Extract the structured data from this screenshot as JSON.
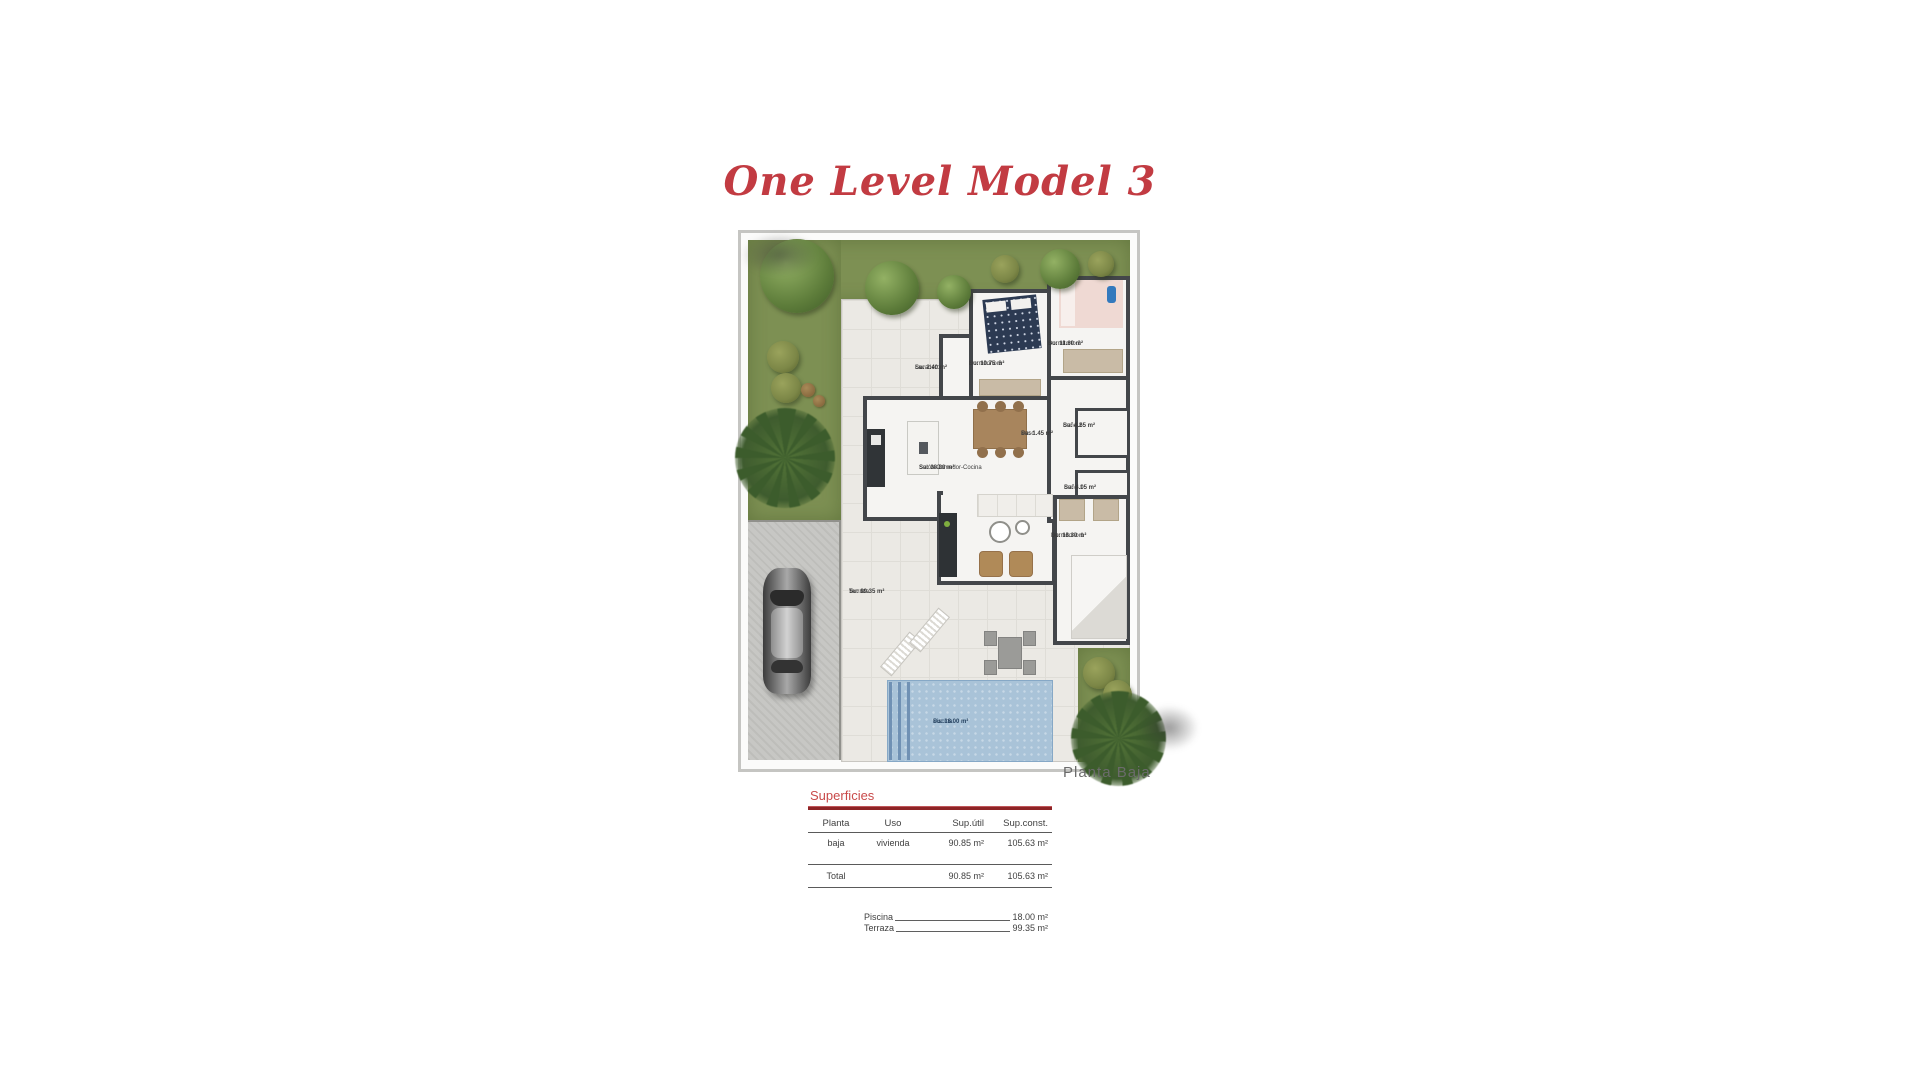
{
  "title": {
    "text": "One Level Model 3"
  },
  "plan": {
    "caption": "Planta Baja",
    "rooms": [
      {
        "name": "Lavadero",
        "area": "Su: 2.40 m²"
      },
      {
        "name": "Dormitorio 3",
        "area": "Su: 10.75 m²"
      },
      {
        "name": "Dormitorio 2",
        "area": "Su: 11.60 m²"
      },
      {
        "name": "Paso",
        "area": "Su: 1.45 m²"
      },
      {
        "name": "Baño 2",
        "area": "Su: 4.65 m²"
      },
      {
        "name": "Salón-Comedor-Cocina",
        "area": "Su: 38.80 m²"
      },
      {
        "name": "Baño 1",
        "area": "Su: 4.05 m²"
      },
      {
        "name": "Dormitorio 1",
        "area": "Su: 16.30 m²"
      },
      {
        "name": "Terraza",
        "area": "Su: 99.35 m²"
      },
      {
        "name": "Piscina",
        "area": "Su: 18.00 m²"
      }
    ]
  },
  "superficies": {
    "title": "Superficies",
    "headers": {
      "planta": "Planta",
      "uso": "Uso",
      "sup_util": "Sup.útil",
      "sup_const": "Sup.const."
    },
    "row": {
      "planta": "baja",
      "uso": "vivienda",
      "sup_util": "90.85 m²",
      "sup_const": "105.63 m²"
    },
    "total": {
      "label": "Total",
      "sup_util": "90.85 m²",
      "sup_const": "105.63 m²"
    },
    "extras": [
      {
        "label": "Piscina",
        "value": "18.00 m²"
      },
      {
        "label": "Terraza",
        "value": "99.35 m²"
      }
    ]
  },
  "colors": {
    "title_red": "#c23b42",
    "section_red": "#c94a4a",
    "rule_dark_red": "#8e2426",
    "grass": "#7d9053",
    "pool": "#a9c3d8",
    "wall": "#43464a",
    "driveway": "#c7c7c4"
  }
}
